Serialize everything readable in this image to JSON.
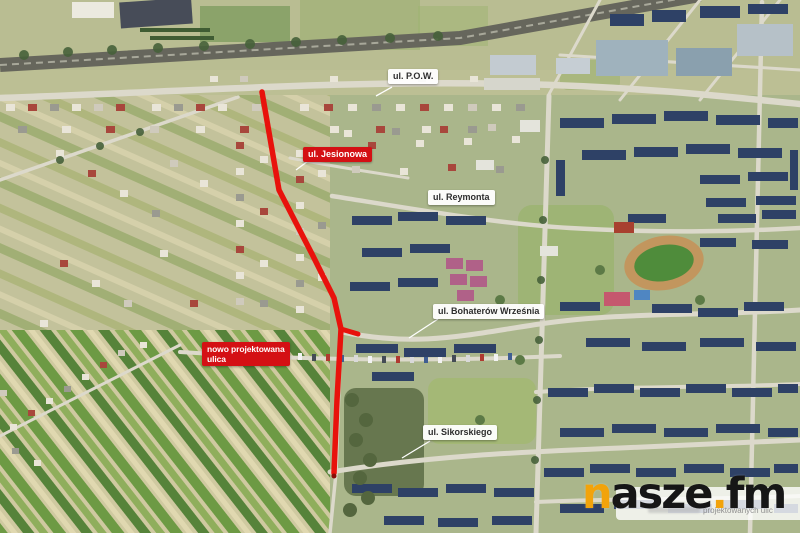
{
  "map": {
    "type": "annotated aerial photograph",
    "labels": {
      "pow": "ul. P.O.W.",
      "jesionowa": "ul. Jesionowa",
      "reymonta": "ul. Reymonta",
      "bohaterow": "ul. Bohaterów Września",
      "nowa_line1": "nowo projektowana",
      "nowa_line2": "ulica",
      "sikorskiego": "ul. Sikorskiego"
    },
    "label_colors": {
      "red_bg": "#d41014",
      "red_text": "#ffffff",
      "white_bg": "#ffffff",
      "white_text": "#2d2d2d"
    },
    "route": {
      "color": "#e8120c",
      "main_points": "262,92 279,190 312,254 334,298 341,329 337,400 334,473",
      "branch_points": "341,329 358,334"
    },
    "watermark": {
      "brand_n": "n",
      "brand_asze": "asze",
      "brand_dot": ".",
      "brand_fm": "fm",
      "orange": "#f2a30b",
      "dark": "#161616",
      "caption_fragment": "projektowanych ulic"
    }
  }
}
